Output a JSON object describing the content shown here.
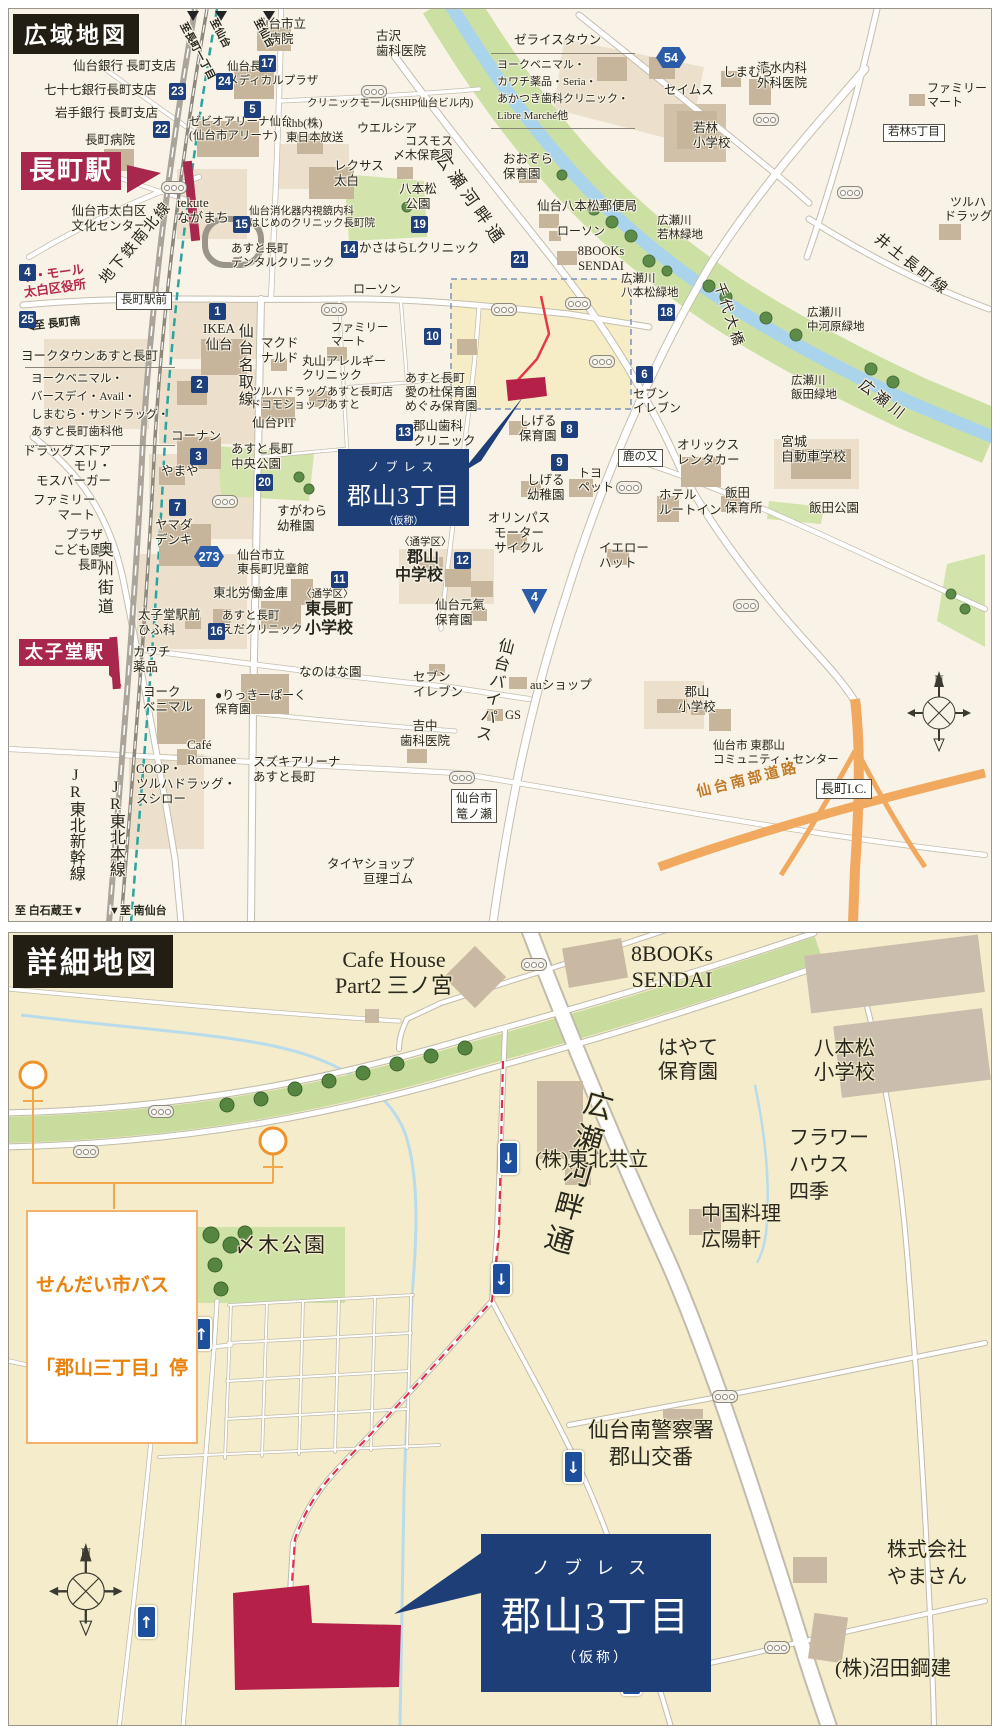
{
  "site": {
    "kana": "ノブレス",
    "name": "郡山3丁目",
    "suffix": "（仮称）"
  },
  "colors": {
    "navy": "#1e3e77",
    "crimson": "#a8274c",
    "site_red": "#b52048",
    "badge_navy": "#1d3f7d",
    "bus_orange": "#e8820c",
    "highway_orange": "#f0a95e",
    "river_blue": "#a9d4ec",
    "green": "#cce0a4",
    "road_white": "#ffffff",
    "header_black": "#221e14"
  },
  "wide_map": {
    "title": "広域地図",
    "stations": [
      "長町駅",
      "太子堂駅"
    ],
    "labels": [
      {
        "t": "仙台銀行 長町支店",
        "x": 64,
        "y": 50
      },
      {
        "t": "七十七銀行長町支店",
        "x": 35,
        "y": 74
      },
      {
        "t": "岩手銀行 長町支店",
        "x": 46,
        "y": 97
      },
      {
        "t": "長町病院",
        "x": 76,
        "y": 124
      },
      {
        "t": "仙台市立\n病院",
        "x": 240,
        "y": 8,
        "ta": "center",
        "w": 64
      },
      {
        "t": "仙台長町\nメディカルプラザ",
        "x": 218,
        "y": 52,
        "fs": 11.5
      },
      {
        "t": "古沢\n歯科医院",
        "x": 367,
        "y": 20
      },
      {
        "t": "ゼライスタウン",
        "x": 505,
        "y": 24
      },
      {
        "t": "ヨークベニマル・\nカワチ薬品・Seria・\nあかつき歯科クリニック・\nLibre Marché他",
        "x": 482,
        "y": 44,
        "fs": 11,
        "cls": "bracket"
      },
      {
        "t": "クリニックモール(SHIP仙台ビル内)",
        "x": 298,
        "y": 89,
        "fs": 10.5
      },
      {
        "t": "ゼビオアリーナ仙台\n(仙台市アリーナ)",
        "x": 180,
        "y": 107,
        "fs": 11.5
      },
      {
        "t": "khb(株)\n東日本放送",
        "x": 277,
        "y": 109,
        "fs": 11.5
      },
      {
        "t": "ウエルシア",
        "x": 348,
        "y": 112,
        "fs": 12
      },
      {
        "t": "コスモス\n〆木保育園",
        "x": 372,
        "y": 125,
        "fs": 12,
        "ta": "right",
        "w": 72
      },
      {
        "t": "レクサス\n太白",
        "x": 325,
        "y": 150
      },
      {
        "t": "八本松\n公園",
        "x": 384,
        "y": 173,
        "ta": "center",
        "w": 50
      },
      {
        "t": "おおぞら\n保育園",
        "x": 494,
        "y": 143
      },
      {
        "t": "仙台八本松郵便局",
        "x": 528,
        "y": 190
      },
      {
        "t": "ローソン",
        "x": 548,
        "y": 215,
        "fs": 12
      },
      {
        "t": "8BOOKs\nSENDAI",
        "x": 562,
        "y": 235,
        "ta": "center",
        "w": 60
      },
      {
        "t": "広瀬川\n若林緑地",
        "x": 648,
        "y": 206,
        "fs": 11.5
      },
      {
        "t": "広瀬川\n八本松緑地",
        "x": 612,
        "y": 264,
        "fs": 11.5
      },
      {
        "t": "かさはらLクリニック",
        "x": 350,
        "y": 232
      },
      {
        "t": "あすと長町\nデンタルクリニック",
        "x": 222,
        "y": 234,
        "fs": 11.5
      },
      {
        "t": "tekute\nながまち",
        "x": 168,
        "y": 186,
        "fs": 13
      },
      {
        "t": "仙台消化器内視鏡内科\nはじめのクリニック長町院",
        "x": 240,
        "y": 197,
        "fs": 10.5
      },
      {
        "t": "仙台市太白区\n文化センター",
        "x": 52,
        "y": 195,
        "ta": "center",
        "w": 96
      },
      {
        "t": "ザ・モール\n太白区役所",
        "x": 12,
        "y": 262,
        "c": "#b5294e",
        "b": 1,
        "r": -8
      },
      {
        "t": "地下鉄南北線",
        "x": 88,
        "y": 268,
        "fs": 15,
        "r": -50,
        "ls": 2
      },
      {
        "t": "◀至 長町南",
        "x": 16,
        "y": 312,
        "fs": 11,
        "b": 1,
        "r": -6
      },
      {
        "t": "ヨークタウンあすと長町",
        "x": 12,
        "y": 340
      },
      {
        "t": "ヨークベニマル・\nバースデイ・Avail・\nしまむら・サンドラッグ・\nあすと長町歯科他",
        "x": 16,
        "y": 358,
        "fs": 11.5,
        "cls": "bracket"
      },
      {
        "t": "IKEA\n仙台",
        "x": 186,
        "y": 312,
        "fs": 13.5,
        "ta": "center",
        "w": 48
      },
      {
        "t": "仙台名取線",
        "x": 226,
        "y": 314,
        "fs": 15,
        "v": 1,
        "ls": 2
      },
      {
        "t": "マクド\nナルド",
        "x": 252,
        "y": 327
      },
      {
        "t": "ファミリー\nマート",
        "x": 322,
        "y": 313,
        "fs": 11.5
      },
      {
        "t": "丸山アレルギー\nクリニック",
        "x": 293,
        "y": 345,
        "fs": 12
      },
      {
        "t": "ツルハドラッグあすと長町店\nドコモショップあすと",
        "x": 241,
        "y": 377,
        "fs": 11
      },
      {
        "t": "仙台PIT",
        "x": 243,
        "y": 407
      },
      {
        "t": "あすと長町\n愛の杜保育園\nめぐみ保育園",
        "x": 396,
        "y": 362,
        "fs": 12
      },
      {
        "t": "セブン\nイレブン",
        "x": 624,
        "y": 378,
        "fs": 12
      },
      {
        "t": "しげる\n保育園",
        "x": 510,
        "y": 405
      },
      {
        "t": "コーナン",
        "x": 162,
        "y": 420
      },
      {
        "t": "あすと長町\n中央公園",
        "x": 222,
        "y": 433
      },
      {
        "t": "やまや",
        "x": 152,
        "y": 455
      },
      {
        "t": "郡山歯科\nクリニック",
        "x": 404,
        "y": 410
      },
      {
        "t": "トヨ\nペット",
        "x": 569,
        "y": 457,
        "fs": 12
      },
      {
        "t": "しげる\n幼稚園",
        "x": 518,
        "y": 464
      },
      {
        "t": "オリンパス\nモーター\nサイクル",
        "x": 478,
        "y": 502,
        "ta": "center",
        "w": 64
      },
      {
        "t": "オリックス\nレンタカー",
        "x": 668,
        "y": 429
      },
      {
        "t": "宮城\n自動車学校",
        "x": 772,
        "y": 425,
        "fs": 13
      },
      {
        "t": "ホテル\nルートイン",
        "x": 650,
        "y": 479
      },
      {
        "t": "飯田\n保育所",
        "x": 716,
        "y": 477
      },
      {
        "t": "飯田公園",
        "x": 800,
        "y": 492
      },
      {
        "t": "イエロー\nハット",
        "x": 590,
        "y": 532
      },
      {
        "t": "ドラッグストア\nモリ・\nモスバーガー",
        "x": 8,
        "y": 435,
        "ta": "right",
        "w": 94
      },
      {
        "t": "ファミリー\nマート",
        "x": 24,
        "y": 484,
        "ta": "right",
        "w": 62
      },
      {
        "t": "ヤマダ\nデンキ",
        "x": 146,
        "y": 509
      },
      {
        "t": "プラザ\nこども園\n長町",
        "x": 36,
        "y": 519,
        "ta": "right",
        "w": 58
      },
      {
        "t": "奥州街道",
        "x": 84,
        "y": 532,
        "fs": 16,
        "v": 1,
        "ls": 3
      },
      {
        "t": "すがわら\n幼稚園",
        "x": 268,
        "y": 495
      },
      {
        "t": "仙台市立\n東長町児童館",
        "x": 228,
        "y": 539,
        "fs": 12
      },
      {
        "t": "東北労働金庫",
        "x": 204,
        "y": 577
      },
      {
        "t": "〈通学区〉",
        "x": 292,
        "y": 580,
        "fs": 10.5
      },
      {
        "t": "東長町\n小学校",
        "x": 288,
        "y": 592,
        "fs": 16,
        "b": 1,
        "ta": "center",
        "w": 64
      },
      {
        "t": "〈通学区〉",
        "x": 390,
        "y": 528,
        "fs": 10.5
      },
      {
        "t": "郡山",
        "x": 398,
        "y": 540,
        "fs": 16,
        "b": 1
      },
      {
        "t": "中学校",
        "x": 386,
        "y": 558,
        "fs": 16,
        "b": 1
      },
      {
        "t": "仙台元氣\n保育園",
        "x": 426,
        "y": 589
      },
      {
        "t": "仙台バイパス",
        "x": 487,
        "y": 626,
        "fs": 16,
        "v": 1,
        "r": 14,
        "ls": 2
      },
      {
        "t": "太子堂駅前\nひふ科",
        "x": 129,
        "y": 599
      },
      {
        "t": "あすと長町\nえだクリニック",
        "x": 213,
        "y": 601,
        "fs": 11.5
      },
      {
        "t": "なのはな園",
        "x": 290,
        "y": 656
      },
      {
        "t": "カワチ\n薬品",
        "x": 124,
        "y": 636
      },
      {
        "t": "ヨーク\nベニマル",
        "x": 134,
        "y": 676
      },
      {
        "t": "●りっきーぱーく\n保育園",
        "x": 206,
        "y": 679,
        "fs": 12
      },
      {
        "t": "セブン\nイレブン",
        "x": 404,
        "y": 661
      },
      {
        "t": "auショップ",
        "x": 521,
        "y": 669
      },
      {
        "t": "GS",
        "x": 496,
        "y": 699
      },
      {
        "t": "吉中\n歯科医院",
        "x": 384,
        "y": 710,
        "ta": "center",
        "w": 64
      },
      {
        "t": "郡山\n小学校",
        "x": 662,
        "y": 676,
        "ta": "center",
        "w": 52
      },
      {
        "t": "仙台市 東郡山\nコミュニティ・センター",
        "x": 704,
        "y": 731,
        "fs": 11.5
      },
      {
        "t": "Café\nRomanee",
        "x": 178,
        "y": 728,
        "fs": 13
      },
      {
        "t": "スズキアリーナ\nあすと長町",
        "x": 244,
        "y": 746
      },
      {
        "t": "COOP・\nツルハドラッグ・\nスシロー",
        "x": 127,
        "y": 753
      },
      {
        "t": "JR東北新幹線",
        "x": 56,
        "y": 758,
        "fs": 16,
        "v": 1
      },
      {
        "t": "JR東北本線",
        "x": 96,
        "y": 770,
        "fs": 16,
        "v": 1
      },
      {
        "t": "タイヤショップ\n亘理ゴム",
        "x": 318,
        "y": 848,
        "ta": "right",
        "w": 86
      },
      {
        "t": "至 白石蔵王▼",
        "x": 6,
        "y": 896,
        "fs": 11,
        "b": 1
      },
      {
        "t": "▼至 南仙台",
        "x": 100,
        "y": 896,
        "fs": 11,
        "b": 1
      },
      {
        "t": "仙台南部道路",
        "x": 686,
        "y": 776,
        "fs": 14.5,
        "c": "#c07a28",
        "b": 1,
        "r": -14,
        "ls": 3
      },
      {
        "t": "千代大橋",
        "x": 716,
        "y": 272,
        "fs": 14,
        "r": 72,
        "ls": 3
      },
      {
        "t": "広瀬川",
        "x": 856,
        "y": 368,
        "fs": 15,
        "r": 38,
        "ls": 4
      },
      {
        "t": "広瀬川\n中河原緑地",
        "x": 798,
        "y": 298,
        "fs": 11.5
      },
      {
        "t": "広瀬川\n飯田緑地",
        "x": 782,
        "y": 366,
        "fs": 11.5
      },
      {
        "t": "井土長町線",
        "x": 872,
        "y": 222,
        "fs": 15,
        "r": 38,
        "ls": 3
      },
      {
        "t": "ツルハ\nドラッグ",
        "x": 930,
        "y": 186,
        "fs": 12,
        "ta": "center",
        "w": 58
      },
      {
        "t": "ファミリー\nマート",
        "x": 918,
        "y": 72,
        "fs": 12
      },
      {
        "t": "清水内科\n外科医院",
        "x": 748,
        "y": 52
      },
      {
        "t": "しまむら",
        "x": 714,
        "y": 56
      },
      {
        "t": "セイムス",
        "x": 655,
        "y": 74
      },
      {
        "t": "若林\n小学校",
        "x": 684,
        "y": 112
      },
      {
        "t": "ローソン",
        "x": 344,
        "y": 273,
        "fs": 12
      },
      {
        "t": "至長町一丁目",
        "x": 178,
        "y": 12,
        "fs": 10.5,
        "r": 62,
        "b": 1
      },
      {
        "t": "至仙台",
        "x": 208,
        "y": 8,
        "fs": 10.5,
        "r": 62,
        "b": 1
      },
      {
        "t": "至仙台",
        "x": 252,
        "y": 8,
        "fs": 10.5,
        "r": 62,
        "b": 1
      },
      {
        "t": "広瀬河畔通",
        "x": 438,
        "y": 140,
        "fs": 17,
        "r": 55,
        "ls": 5
      },
      {
        "t": "鹿の又",
        "x": 609,
        "y": 440,
        "cls": "wbox",
        "fs": 11.5
      },
      {
        "t": "長町駅前",
        "x": 107,
        "y": 283,
        "cls": "wbox",
        "fs": 11.5
      },
      {
        "t": "若林5丁目",
        "x": 874,
        "y": 115,
        "cls": "wbox",
        "fs": 11.5
      },
      {
        "t": "仙台市\n篭ノ瀬",
        "x": 442,
        "y": 780,
        "cls": "wbox",
        "fs": 12,
        "ta": "center"
      },
      {
        "t": "長町I.C.",
        "x": 807,
        "y": 770,
        "cls": "wbox",
        "fs": 13
      }
    ],
    "badges": [
      {
        "n": "1",
        "x": 200,
        "y": 294
      },
      {
        "n": "2",
        "x": 182,
        "y": 367
      },
      {
        "n": "3",
        "x": 181,
        "y": 439
      },
      {
        "n": "4",
        "x": 10,
        "y": 255
      },
      {
        "n": "5",
        "x": 235,
        "y": 92
      },
      {
        "n": "6",
        "x": 627,
        "y": 357
      },
      {
        "n": "7",
        "x": 160,
        "y": 490
      },
      {
        "n": "8",
        "x": 552,
        "y": 412
      },
      {
        "n": "9",
        "x": 542,
        "y": 445
      },
      {
        "n": "10",
        "x": 415,
        "y": 319
      },
      {
        "n": "11",
        "x": 322,
        "y": 562
      },
      {
        "n": "12",
        "x": 445,
        "y": 543
      },
      {
        "n": "13",
        "x": 387,
        "y": 415
      },
      {
        "n": "14",
        "x": 332,
        "y": 232
      },
      {
        "n": "15",
        "x": 224,
        "y": 207
      },
      {
        "n": "16",
        "x": 199,
        "y": 614
      },
      {
        "n": "17",
        "x": 250,
        "y": 46
      },
      {
        "n": "18",
        "x": 649,
        "y": 295
      },
      {
        "n": "19",
        "x": 402,
        "y": 207
      },
      {
        "n": "20",
        "x": 247,
        "y": 465
      },
      {
        "n": "21",
        "x": 502,
        "y": 242
      },
      {
        "n": "22",
        "x": 144,
        "y": 112
      },
      {
        "n": "23",
        "x": 160,
        "y": 74
      },
      {
        "n": "24",
        "x": 207,
        "y": 64
      },
      {
        "n": "25",
        "x": 10,
        "y": 302
      }
    ],
    "shields": [
      {
        "n": "54",
        "x": 647,
        "y": 38,
        "shape": "hex"
      },
      {
        "n": "273",
        "x": 185,
        "y": 537,
        "shape": "hex"
      },
      {
        "n": "4",
        "x": 512,
        "y": 580,
        "shape": "tri"
      }
    ],
    "signals": [
      {
        "x": 152,
        "y": 172
      },
      {
        "x": 136,
        "y": 283
      },
      {
        "x": 312,
        "y": 294
      },
      {
        "x": 482,
        "y": 294
      },
      {
        "x": 556,
        "y": 288
      },
      {
        "x": 580,
        "y": 346
      },
      {
        "x": 352,
        "y": 76
      },
      {
        "x": 744,
        "y": 104
      },
      {
        "x": 828,
        "y": 177
      },
      {
        "x": 203,
        "y": 486
      },
      {
        "x": 440,
        "y": 762
      },
      {
        "x": 724,
        "y": 590
      },
      {
        "x": 607,
        "y": 472
      }
    ]
  },
  "detail_map": {
    "title": "詳細地図",
    "bus_stop": {
      "line1": "せんだい市バス",
      "line2": "「郡山三丁目」停"
    },
    "labels": [
      {
        "t": "Cafe House\nPart2 三ノ宮",
        "x": 285,
        "y": 14,
        "fs": 22,
        "ta": "center",
        "w": 200
      },
      {
        "t": "8BOOKs\nSENDAI",
        "x": 608,
        "y": 8,
        "fs": 22,
        "ta": "center",
        "w": 110
      },
      {
        "t": "はやて\n保育園",
        "x": 634,
        "y": 104,
        "fs": 20,
        "ta": "center",
        "w": 90
      },
      {
        "t": "八本松\n小学校",
        "x": 788,
        "y": 104,
        "fs": 20.5,
        "ta": "center",
        "w": 95
      },
      {
        "t": "広瀬河畔通",
        "x": 574,
        "y": 152,
        "fs": 29,
        "v": 1,
        "r": 16,
        "ls": 6
      },
      {
        "t": "〆木公園",
        "x": 226,
        "y": 300,
        "fs": 21,
        "ls": 2
      },
      {
        "t": "(株)東北共立",
        "x": 526,
        "y": 216,
        "fs": 20
      },
      {
        "t": "フラワー\nハウス\n四季",
        "x": 780,
        "y": 192,
        "fs": 20,
        "lh": 1.35
      },
      {
        "t": "中国料理\n広陽軒",
        "x": 692,
        "y": 268,
        "fs": 20,
        "lh": 1.3
      },
      {
        "t": "仙台南警察署\n郡山交番",
        "x": 542,
        "y": 484,
        "fs": 21,
        "ta": "center",
        "w": 200,
        "lh": 1.3
      },
      {
        "t": "株式会社\nやまさん",
        "x": 862,
        "y": 604,
        "fs": 20,
        "ta": "center",
        "w": 112,
        "lh": 1.35
      },
      {
        "t": "(株)沼田鋼建",
        "x": 826,
        "y": 724,
        "fs": 20.5
      }
    ],
    "arrows": [
      {
        "g": "↓",
        "x": 489,
        "y": 208
      },
      {
        "g": "↓",
        "x": 482,
        "y": 329
      },
      {
        "g": "↑",
        "x": 182,
        "y": 384
      },
      {
        "g": "↓",
        "x": 554,
        "y": 517
      },
      {
        "g": "↑",
        "x": 127,
        "y": 672
      },
      {
        "g": "↓",
        "x": 612,
        "y": 729
      }
    ],
    "signals": [
      {
        "x": 512,
        "y": 25
      },
      {
        "x": 139,
        "y": 172
      },
      {
        "x": 64,
        "y": 212
      },
      {
        "x": 703,
        "y": 457
      },
      {
        "x": 755,
        "y": 708
      }
    ]
  }
}
